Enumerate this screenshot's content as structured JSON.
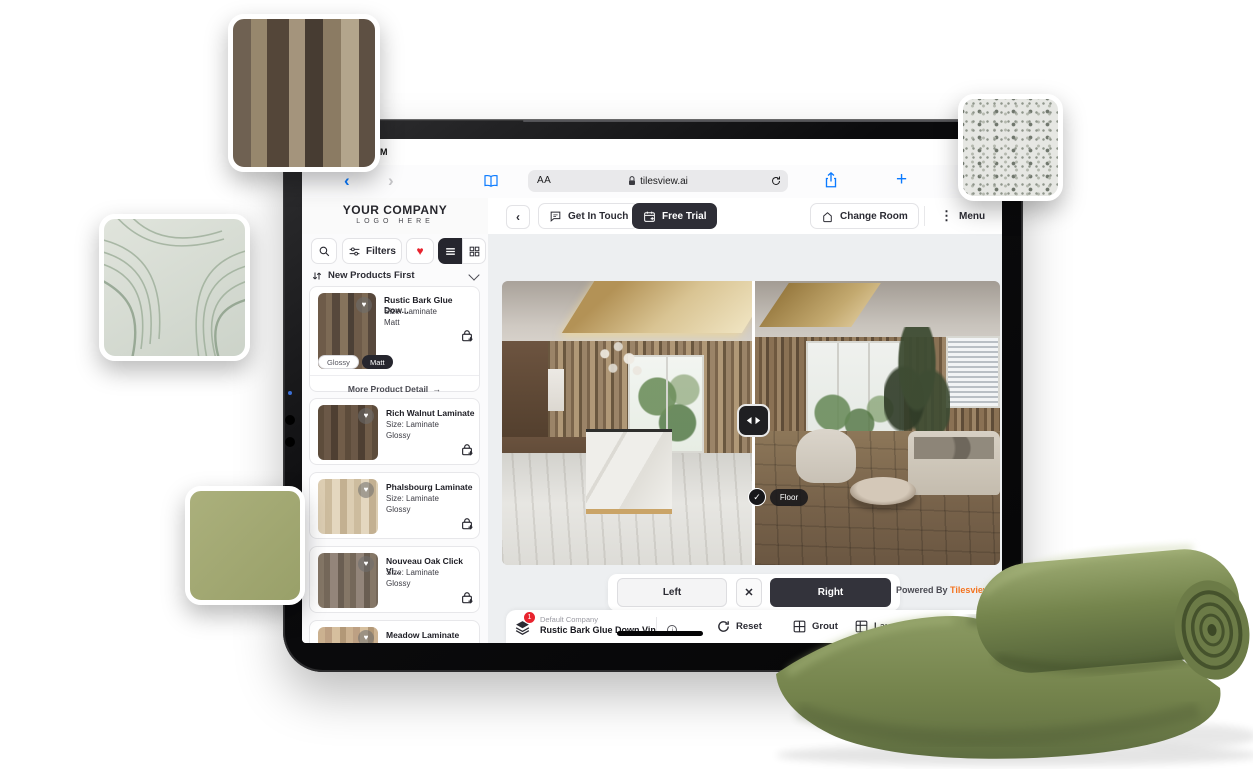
{
  "status": {
    "time": "PM"
  },
  "browser": {
    "reader_button": "AA",
    "url": "tilesview.ai"
  },
  "header": {
    "logo_line1": "YOUR COMPANY",
    "logo_line2": "LOGO HERE",
    "get_in_touch": "Get In Touch",
    "free_trial": "Free Trial",
    "change_room": "Change Room",
    "menu": "Menu"
  },
  "sidebar": {
    "filters": "Filters",
    "sort": "New Products First",
    "products": [
      {
        "title": "Rustic Bark Glue Dow...",
        "size": "Size: Laminate",
        "finish": "Matt",
        "chip_glossy": "Glossy",
        "chip_matt": "Matt",
        "more": "More Product Detail"
      },
      {
        "title": "Rich Walnut Laminate",
        "size": "Size: Laminate",
        "finish": "Glossy"
      },
      {
        "title": "Phalsbourg Laminate",
        "size": "Size: Laminate",
        "finish": "Glossy"
      },
      {
        "title": "Nouveau Oak Click Vi...",
        "size": "Size: Laminate",
        "finish": "Glossy"
      },
      {
        "title": "Meadow Laminate",
        "size": "Size: Laminate"
      }
    ]
  },
  "viewer": {
    "floor_tag": "Floor",
    "left_button": "Left",
    "right_button": "Right",
    "powered_by": "Powered By ",
    "brand": "Tilesview"
  },
  "toolbar": {
    "badge_count": "1",
    "company": "Default Company",
    "product": "Rustic Bark Glue Down Vin...",
    "reset": "Reset",
    "grout": "Grout",
    "layout": "Layout",
    "compare": "Com"
  },
  "icons": {
    "back": "‹",
    "forward": "›",
    "collapse": "‹",
    "menu_dots": "⋮",
    "close": "✕",
    "arrow_right": "→",
    "heart": "♥",
    "plus": "+",
    "check": "✓",
    "info": "i"
  },
  "colors": {
    "accent_blue": "#0a7aff",
    "dark_button": "#2e2e36",
    "brand_orange": "#f4731f",
    "heart_red": "#e8232e",
    "swatch_green": "#a2a873",
    "carpet_green": "#74834c"
  }
}
